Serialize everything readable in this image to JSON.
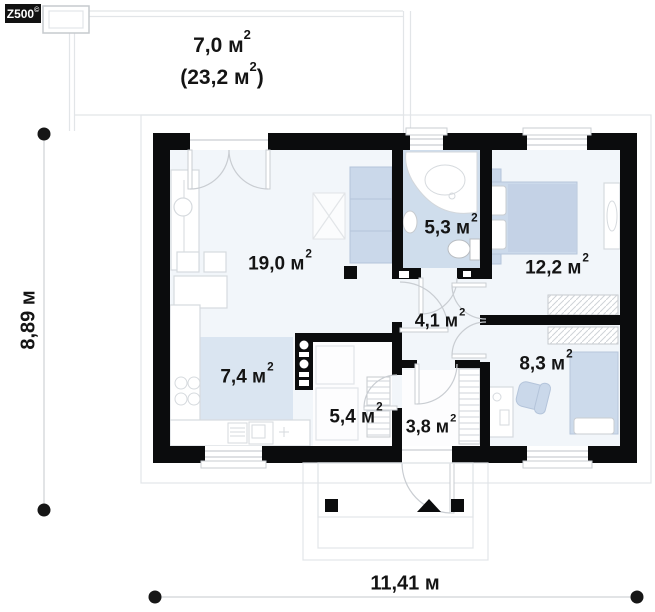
{
  "logo": {
    "brand": "Z500",
    "mark": "©"
  },
  "terrace": {
    "line1": "7,0 м",
    "line2_open": "(23,2 м",
    "line2_close": ")",
    "sup": "2"
  },
  "rooms": {
    "living": {
      "area": "19,0 м",
      "sup": "2"
    },
    "kitchen": {
      "area": "7,4 м",
      "sup": "2"
    },
    "bathroom": {
      "area": "5,3 м",
      "sup": "2"
    },
    "bedroom": {
      "area": "12,2 м",
      "sup": "2"
    },
    "hall": {
      "area": "4,1 м",
      "sup": "2"
    },
    "office": {
      "area": "8,3 м",
      "sup": "2"
    },
    "utility": {
      "area": "5,4 м",
      "sup": "2"
    },
    "entry": {
      "area": "3,8 м",
      "sup": "2"
    }
  },
  "dimensions": {
    "width": "11,41 м",
    "height": "8,89 м"
  },
  "colors": {
    "wall": "#0b0c0d",
    "floor": "#f2f6fa",
    "bathroom-floor": "#cfddec",
    "kitchen-rug": "#dae5f1",
    "accent-soft": "#cad8ea"
  }
}
